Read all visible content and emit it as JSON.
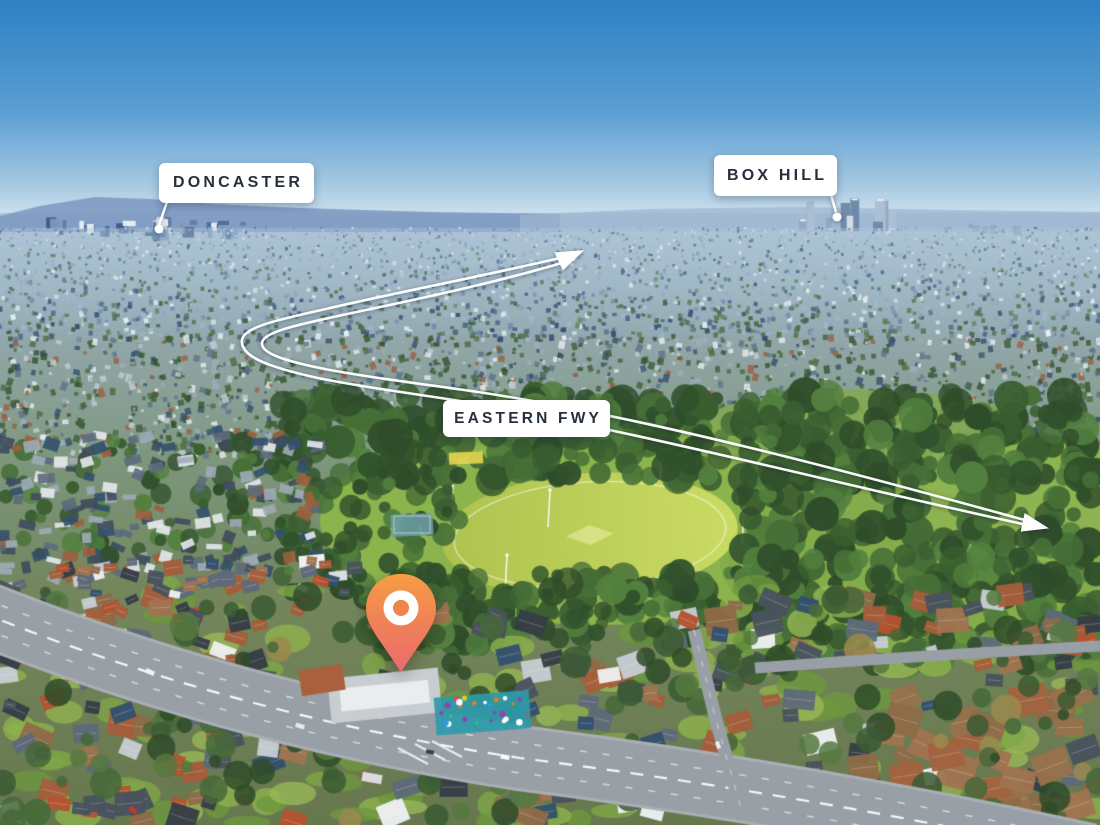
{
  "labels": {
    "doncaster": "DONCASTER",
    "box_hill": "BOX HILL",
    "eastern_fwy": "EASTERN FWY"
  },
  "marker": {
    "icon": "location-pin-icon"
  },
  "colors": {
    "sky_top": "#2E81C4",
    "sky_mid": "#5B9FD3",
    "sky_low": "#A7C9E2",
    "sky_horizon": "#D8E9F3",
    "mountain": "#7E9AC2",
    "far_ridge": "#9FB6D2",
    "haze_band_top": "#AFC6D8",
    "haze_band_bottom": "#8FA6AC",
    "field_light": "#CBDC64",
    "field_dark": "#AEC24F",
    "park_grass": "#8CB44D",
    "road": "#999FA6",
    "kerb": "#A9AFB5",
    "label_bg": "#FFFFFF",
    "label_text": "#25303C",
    "arrow": "#FFFFFF",
    "pin_top": "#F59D43",
    "pin_mid": "#EF7F58",
    "pin_bottom": "#EA6A71",
    "pin_ring": "#FFFFFF",
    "pin_hole": "#EF8549",
    "playground_teal": "#2E9AAB"
  }
}
